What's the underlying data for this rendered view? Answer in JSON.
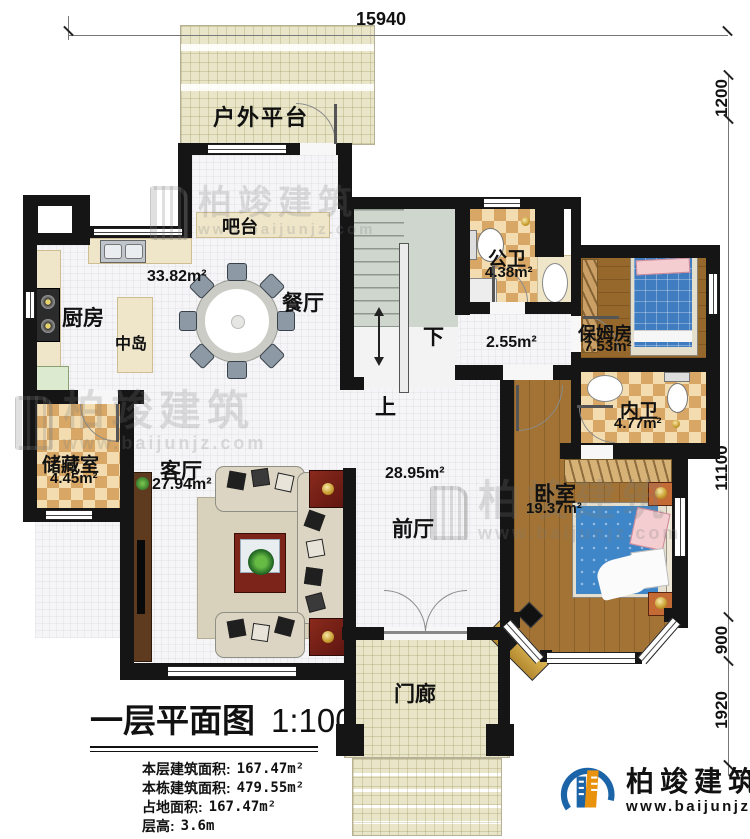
{
  "rooms": {
    "platform": {
      "name": "户外平台"
    },
    "bar": {
      "name": "吧台"
    },
    "kitchen": {
      "name": "厨房"
    },
    "island": {
      "name": "中岛"
    },
    "dining": {
      "name": "餐厅",
      "area": "33.82m²"
    },
    "public_bath": {
      "name": "公卫",
      "area": "4.38m²"
    },
    "hall": {
      "area": "2.55m²"
    },
    "nanny_room": {
      "name": "保姆房",
      "area": "7.53m²"
    },
    "inner_bath": {
      "name": "内卫",
      "area": "4.77m²"
    },
    "storage": {
      "name": "储藏室",
      "area": "4.45m²"
    },
    "living": {
      "name": "客厅",
      "area": "27.94m²"
    },
    "foyer": {
      "name": "前厅",
      "area": "28.95m²"
    },
    "bedroom": {
      "name": "卧室",
      "area": "19.37m²"
    },
    "porch": {
      "name": "门廊"
    },
    "stairs": {
      "down": "下",
      "up": "上"
    }
  },
  "dims": {
    "top": "15940",
    "right": [
      "1200",
      "11100",
      "900",
      "1920"
    ]
  },
  "title_block": {
    "title": "一层平面图",
    "scale": "1:100",
    "stats": [
      {
        "label": "本层建筑面积:",
        "value": "167.47m²"
      },
      {
        "label": "本栋建筑面积:",
        "value": "479.55m²"
      },
      {
        "label": "占地面积:",
        "value": "167.47m²"
      },
      {
        "label": "层高:",
        "value": "3.6m"
      }
    ]
  },
  "brand": {
    "name": "柏竣建筑",
    "url": "www.baijunjz.com"
  }
}
